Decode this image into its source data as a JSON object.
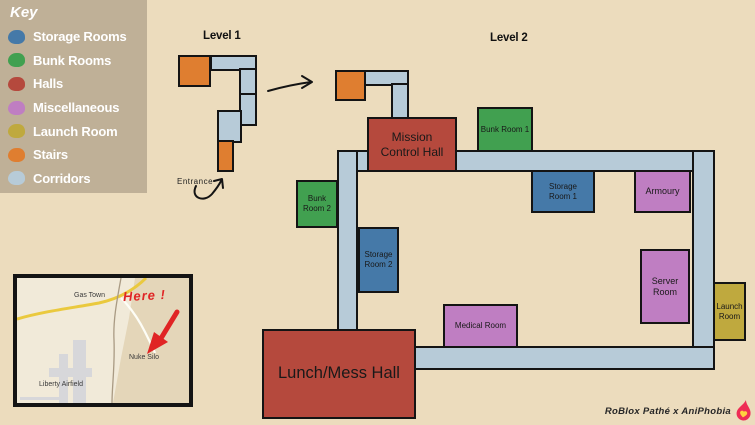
{
  "key": {
    "title": "Key",
    "items": [
      {
        "label": "Storage Rooms"
      },
      {
        "label": "Bunk Rooms"
      },
      {
        "label": "Halls"
      },
      {
        "label": "Miscellaneous"
      },
      {
        "label": "Launch Room"
      },
      {
        "label": "Stairs"
      },
      {
        "label": "Corridors"
      }
    ]
  },
  "colors": {
    "storage": "#4579a8",
    "bunk": "#41a050",
    "halls": "#b5493d",
    "miscellaneous": "#bf7ec2",
    "launch": "#bfa93e",
    "stairs": "#df7e30",
    "corridors": "#b7cbd8",
    "annotation_red": "#e02424",
    "flame": "#ee2d55",
    "flame_heart": "#ffd23f"
  },
  "level1": {
    "title": "Level 1",
    "entrance_label": "Entrance"
  },
  "level2": {
    "title": "Level 2",
    "rooms": {
      "mission_control_hall": {
        "label": "Mission Control Hall"
      },
      "bunk_room_1": {
        "label": "Bunk Room 1"
      },
      "bunk_room_2": {
        "label": "Bunk Room 2"
      },
      "storage_room_1": {
        "label": "Storage Room 1"
      },
      "storage_room_2": {
        "label": "Storage Room 2"
      },
      "armoury": {
        "label": "Armoury"
      },
      "server_room": {
        "label": "Server Room"
      },
      "medical_room": {
        "label": "Medical Room"
      },
      "launch_room": {
        "label": "Launch Room"
      },
      "lunch_mess_hall": {
        "label": "Lunch/Mess Hall"
      }
    }
  },
  "map_inset": {
    "labels": {
      "gas_town": "Gas Town",
      "nuke_silo": "Nuke Silo",
      "liberty_airfield": "Liberty Airfield"
    },
    "annotation": "Here !"
  },
  "credits": {
    "text": "RoBlox Pathé x AniPhobia"
  }
}
